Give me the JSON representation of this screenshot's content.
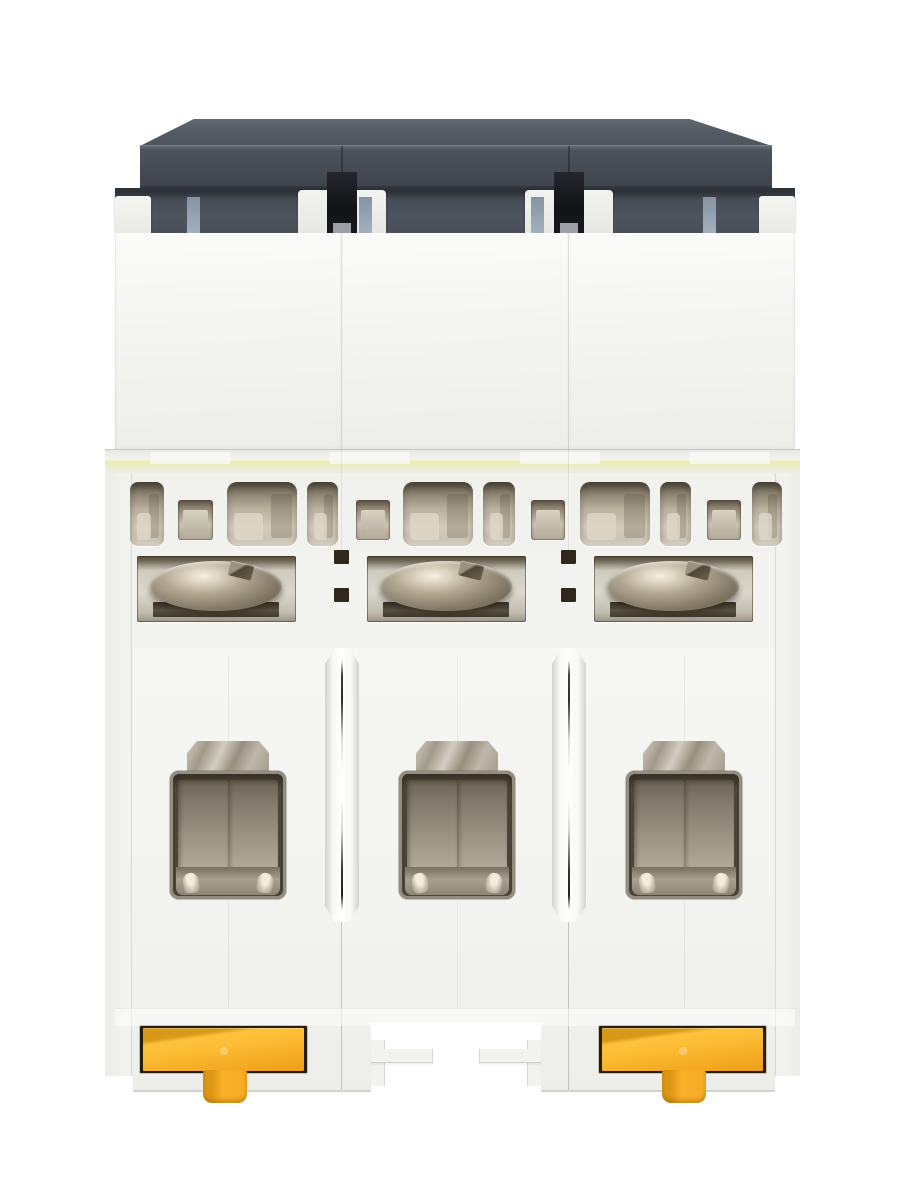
{
  "image": {
    "kind": "product-photo",
    "subject": "Three-pole miniature circuit breaker",
    "view": "Rear view showing busbar slot openings, terminal clamp screws and DIN-rail mounting clips",
    "background": "#ffffff",
    "pole_count": 3
  },
  "parts": {
    "top_cover": "dark rear cover plate",
    "pole_module": "pole housing module",
    "slot_opening": "busbar slot opening",
    "square_opening": "square busbar opening",
    "terminal_screw": "terminal clamp screw",
    "terminal_cage": "wire terminal cage",
    "terminal_clamp": "terminal clamp plate",
    "din_clip": "yellow DIN-rail mounting clip",
    "din_notch": "DIN-rail notch with retaining hooks",
    "divider_slot": "inter-pole divider slot",
    "alignment_tab": "blue-gray alignment tab"
  },
  "counts": {
    "pole_modules": 3,
    "terminal_screws": 3,
    "terminal_cages": 3,
    "din_clips": 2,
    "din_notches": 1,
    "large_slot_openings": 3,
    "medium_slot_openings": 5,
    "square_openings": 4,
    "alignment_tabs": 4,
    "divider_slots": 2
  },
  "palette": {
    "housing": "#f3f3f0",
    "cover_dark": "#474d56",
    "clip_yellow": "#f8b02a",
    "clip_yellow_dark": "#dc9715",
    "metal_bright": "#f2ecdc",
    "metal_mid": "#a89f8d",
    "metal_dark": "#5a5241",
    "cavity_taupe": "#978f80",
    "tab_blue_gray": "#97a5b3",
    "slot_black": "#17191d"
  }
}
